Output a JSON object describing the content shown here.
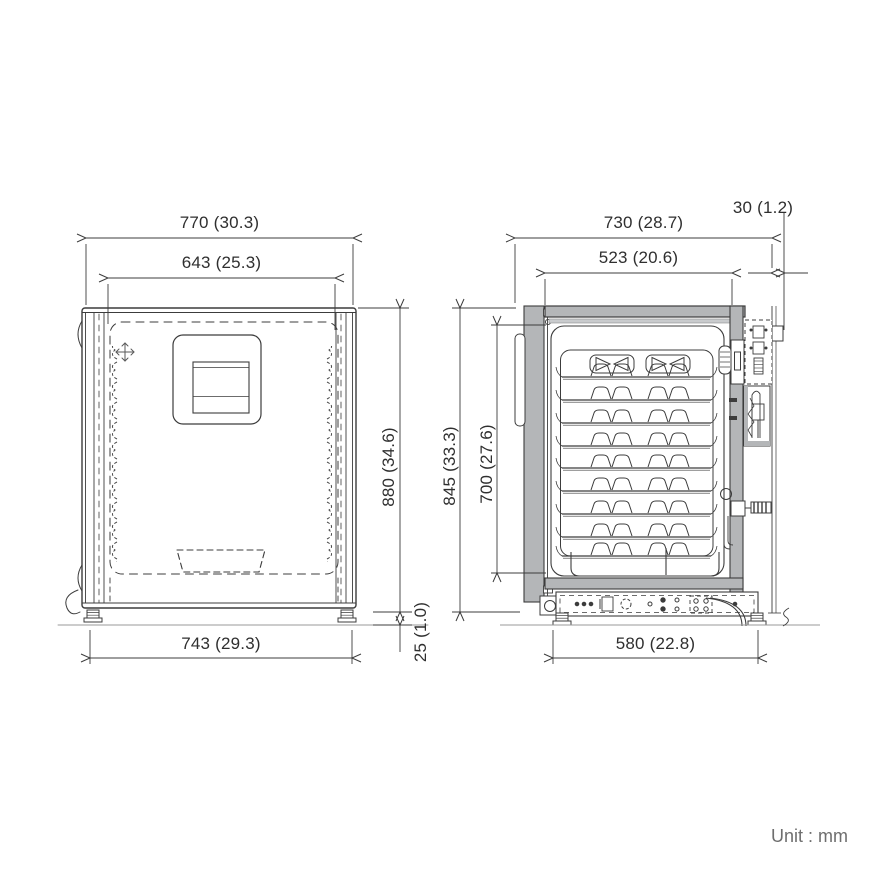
{
  "unit_note": "Unit : mm",
  "views": {
    "front": {
      "label": "front-view",
      "dimensions": {
        "overall_width": "770 (30.3)",
        "door_width": "643 (25.3)",
        "overall_height": "880 (34.6)",
        "base_width": "743 (29.3)",
        "foot_height": "25 (1.0)"
      }
    },
    "side": {
      "label": "side-view",
      "dimensions": {
        "overall_depth": "730 (28.7)",
        "interior_depth": "523 (20.6)",
        "rear_protrusion": "30 (1.2)",
        "body_height": "845 (33.3)",
        "interior_height": "700 (27.6)",
        "base_depth": "580 (22.8)"
      }
    }
  },
  "colors": {
    "line": "#3c3c3c",
    "wall_fill": "#b4b6b8",
    "wall_fill_light": "#c9cbcd",
    "floor_line": "#999999",
    "label_text": "#2f2f2f",
    "unit_text": "#6e6e6e"
  }
}
